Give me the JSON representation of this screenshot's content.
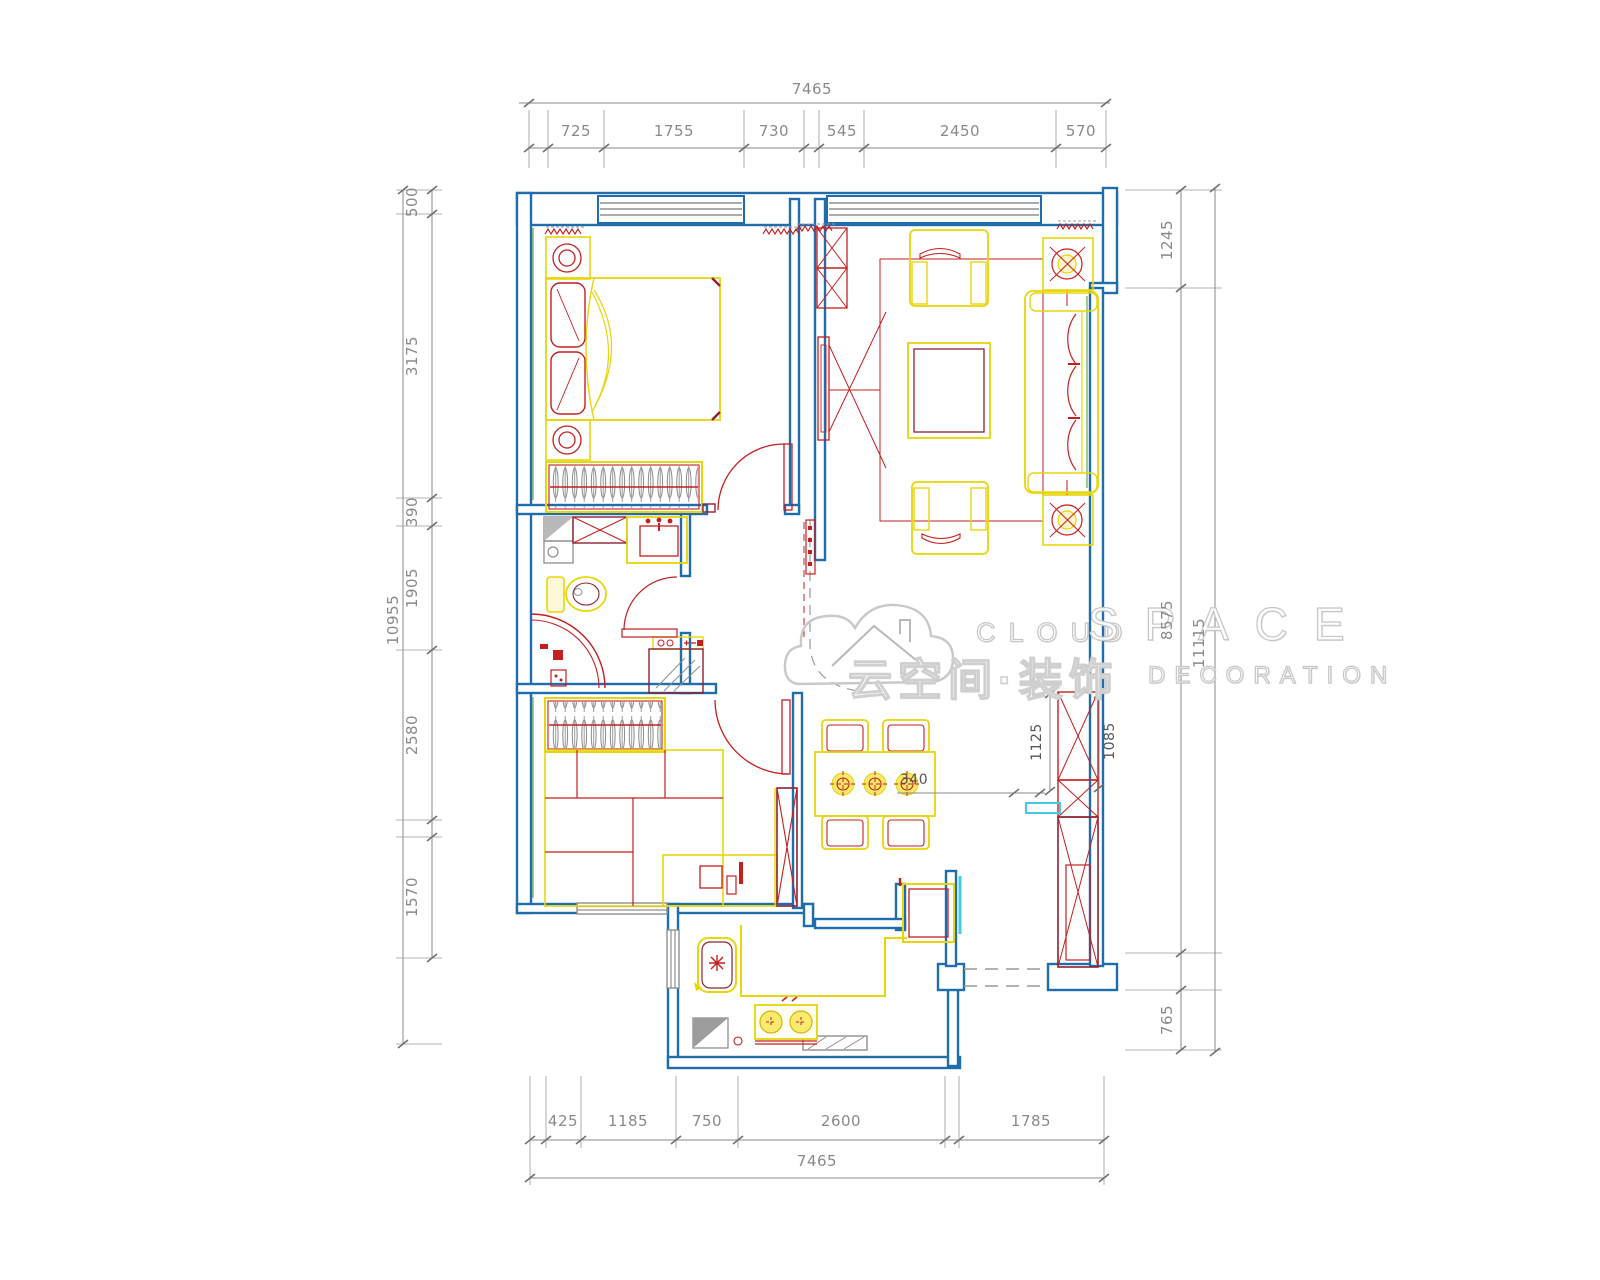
{
  "watermark": {
    "en_cloud": "CLOUD",
    "en_space": "SPACE",
    "cn_brand": "云空间·装饰",
    "en_decoration": "DECORATION"
  },
  "dimensions": {
    "top": {
      "total": "7465",
      "segments": [
        "725",
        "1755",
        "730",
        "545",
        "2450",
        "570"
      ]
    },
    "bottom": {
      "total": "7465",
      "segments": [
        "425",
        "1185",
        "750",
        "2600",
        "1785"
      ]
    },
    "left": {
      "total": "10955",
      "segments": [
        "500",
        "3175",
        "390",
        "1905",
        "2580",
        "1570"
      ]
    },
    "right": {
      "total": "11115",
      "segments": [
        "1245",
        "8575",
        "765"
      ]
    },
    "interior": {
      "d340": "340",
      "d1125": "1125",
      "d1085": "1085"
    }
  },
  "colors": {
    "wall_blue": "#1f6dad",
    "furniture_yellow": "#e8d50a",
    "accent_red": "#c41f1f",
    "maroon": "#8c2332",
    "dim_gray": "#8a8a8a",
    "highlight_cyan": "#45c8e8"
  }
}
